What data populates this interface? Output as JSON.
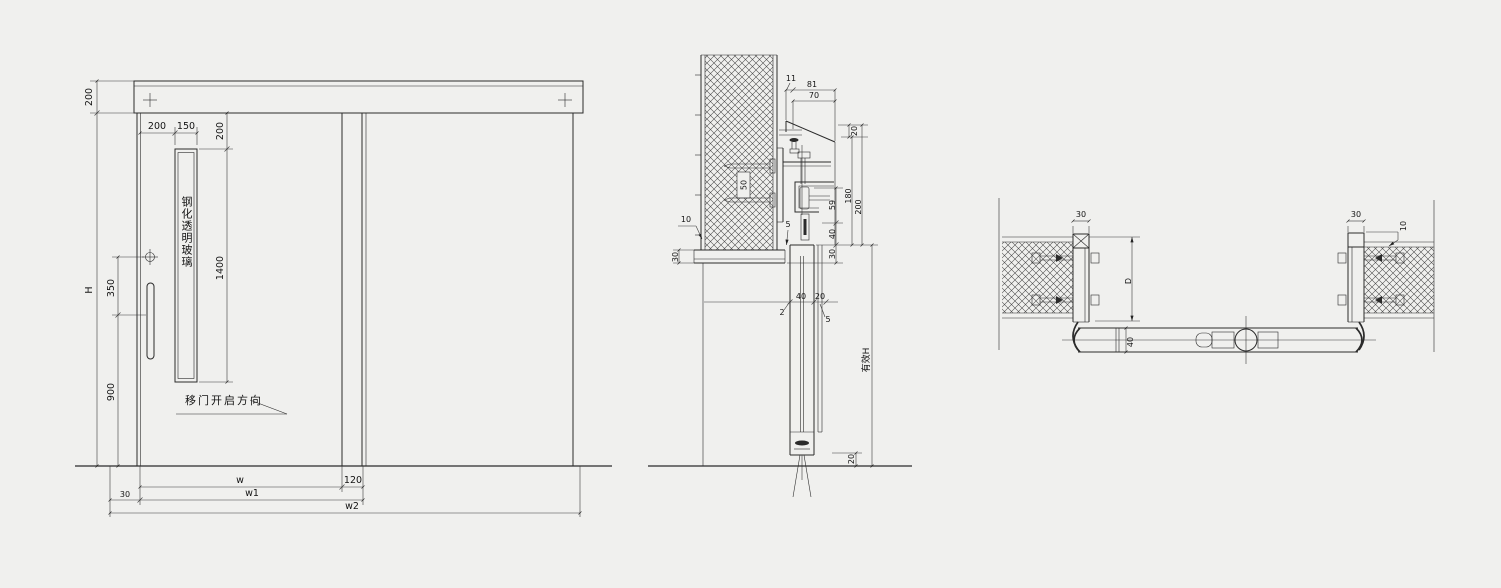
{
  "drawing": {
    "title": "sliding-door-shop-drawing",
    "background": "#f0f0ee",
    "line_color": "#2b2b2b",
    "views": {
      "elevation": {
        "glass_label": "钢化透明玻璃",
        "direction_label": "移门开启方向",
        "dim_header_height": "200",
        "dim_total_height": "H",
        "dim_lock_offset": "350",
        "dim_handle_height": "900",
        "dim_glass_side_offset": "200",
        "dim_glass_width": "150",
        "dim_glass_top_offset": "200",
        "dim_glass_height": "1400",
        "dim_clear_width": "w",
        "dim_overlap": "120",
        "dim_side_clearance": "30",
        "dim_leaf_width": "w1",
        "dim_total_width": "w2"
      },
      "section": {
        "dim_lip": "11",
        "dim_track_total": "81",
        "dim_cover_width": "70",
        "dim_cover_height": "20",
        "dim_hanger_height": "59",
        "dim_track_height": "180",
        "dim_header_depth": "200",
        "dim_roller_drop": "40",
        "dim_bottom_lap": "30",
        "dim_wall_stud": "50",
        "dim_wall_offset": "10",
        "dim_trim_height": "30",
        "dim_top_gap": "5",
        "dim_leaf_thickness": "40",
        "dim_back_clearance": "20",
        "dim_front_gap": "2",
        "dim_rear_gap": "5",
        "dim_floor_gap": "20",
        "label_effective_height": "有效H"
      },
      "plan": {
        "dim_left_jamb": "30",
        "dim_opening": "D",
        "dim_leaf_thickness": "40",
        "dim_right_jamb": "30",
        "dim_wall_gap": "10"
      }
    }
  }
}
